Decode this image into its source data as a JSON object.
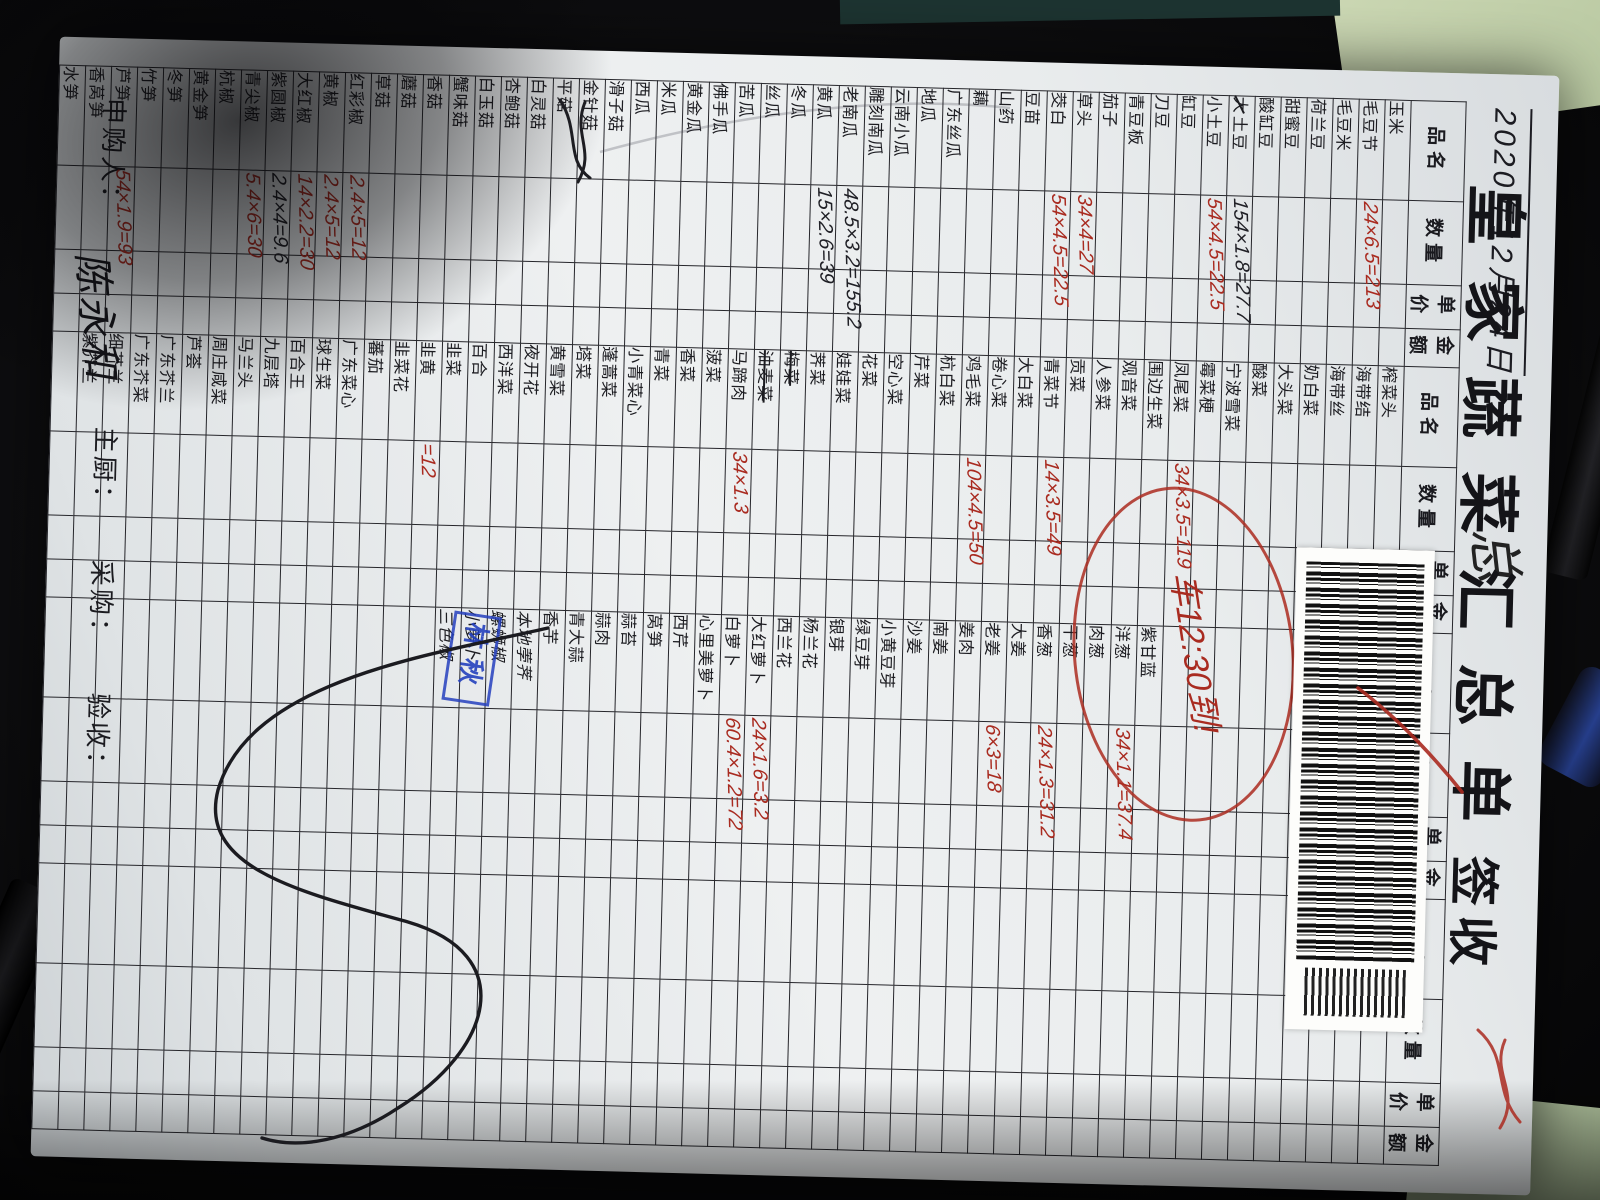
{
  "photo": {
    "background_color": "#0e0e10",
    "paper_color": "#e9eced",
    "grid_color": "#26262b",
    "red_ink": "#a92b20",
    "black_ink": "#202026",
    "stamp_blue": "#2440be",
    "mat_green": "#c2d0ab"
  },
  "header": {
    "date": "2020年12月24日",
    "date_note": "总",
    "title": "皇家蔬菜汇总单",
    "title_suffix": "签收"
  },
  "annotations": {
    "truck_note": "车12:30到!",
    "stamp_text": "林秋"
  },
  "footer": {
    "requester_label": "申购人：",
    "requester_signature": "陈永和",
    "chef_label": "主厨：",
    "purchaser_label": "采购：",
    "receiver_label": "验收："
  },
  "table": {
    "column_headers": [
      "品名",
      "数量",
      "单价",
      "金额"
    ],
    "row_count": 52,
    "groups": [
      {
        "start_row": 1,
        "items": [
          {
            "n": "玉米"
          },
          {
            "n": "毛豆节",
            "q": "24×6.5=213",
            "c": "red"
          },
          {
            "n": "毛豆米"
          },
          {
            "n": "荷兰豆"
          },
          {
            "n": "甜蜜豆"
          },
          {
            "n": "酸缸豆"
          },
          {
            "n": "土豆",
            "pre": "大",
            "q": "154×1.8=27.7",
            "c": "blk"
          },
          {
            "n": "小土豆",
            "q": "54×4.5=22.5",
            "c": "red"
          },
          {
            "n": "缸豆"
          },
          {
            "n": "刀豆"
          },
          {
            "n": "青豆板"
          },
          {
            "n": "茄子"
          },
          {
            "n": "草头",
            "q": "34×4=27",
            "c": "red"
          },
          {
            "n": "茭白",
            "q": "54×4.5=22.5",
            "c": "red"
          },
          {
            "n": "豆苗"
          },
          {
            "n": "山药"
          },
          {
            "n": "藕"
          },
          {
            "n": "广东丝瓜"
          },
          {
            "n": "地瓜"
          },
          {
            "n": "云南小瓜"
          },
          {
            "n": "雕刻南瓜"
          },
          {
            "n": "老南瓜",
            "q": "48.5×3.2=155.2",
            "c": "blk"
          },
          {
            "n": "黄瓜",
            "q": "15×2.6=39",
            "c": "blk"
          },
          {
            "n": "冬瓜"
          },
          {
            "n": "丝瓜"
          },
          {
            "n": "苦瓜"
          },
          {
            "n": "佛手瓜"
          },
          {
            "n": "黄金瓜"
          },
          {
            "n": "米瓜"
          },
          {
            "n": "西瓜"
          },
          {
            "n": "滑子菇"
          },
          {
            "n": "金针菇"
          },
          {
            "n": "平菇"
          },
          {
            "n": "白灵菇"
          },
          {
            "n": "杏鲍菇"
          },
          {
            "n": "白玉菇"
          },
          {
            "n": "蟹味菇"
          },
          {
            "n": "香菇"
          },
          {
            "n": "蘑菇"
          },
          {
            "n": "草菇"
          },
          {
            "n": "红彩椒",
            "q": "2.4×5=12",
            "c": "red"
          },
          {
            "n": "黄椒",
            "q": "2.4×5=12",
            "c": "red"
          },
          {
            "n": "大红椒",
            "q": "14×2.2=30",
            "c": "red"
          },
          {
            "n": "紫圆椒",
            "q": "2.4×4=9.6",
            "c": "blk"
          },
          {
            "n": "青尖椒",
            "q": "5.4×6=30",
            "c": "red"
          },
          {
            "n": "杭椒"
          },
          {
            "n": "黄金笋"
          },
          {
            "n": "冬笋"
          },
          {
            "n": "竹笋"
          },
          {
            "n": "芦笋",
            "q": "54×1.9=93",
            "c": "red"
          },
          {
            "n": "香莴笋"
          },
          {
            "n": "水笋"
          }
        ]
      },
      {
        "start_row": 1,
        "items": [
          {
            "n": "榨菜头"
          },
          {
            "n": "海带结"
          },
          {
            "n": "海带丝"
          },
          {
            "n": "奶白菜"
          },
          {
            "n": "大头菜"
          },
          {
            "n": "酸菜"
          },
          {
            "n": "宁波雪菜"
          },
          {
            "n": "霉菜梗"
          },
          {
            "n": "凤尾菜",
            "q": "34×3.5=119",
            "c": "red"
          },
          {
            "n": "围边生菜"
          },
          {
            "n": "观音菜"
          },
          {
            "n": "人参菜"
          },
          {
            "n": "贡菜"
          },
          {
            "n": "青菜节",
            "q": "14×3.5=49",
            "c": "red"
          },
          {
            "n": "大白菜"
          },
          {
            "n": "卷心菜"
          },
          {
            "n": "鸡毛菜",
            "q": "104×4.5=50",
            "c": "red"
          },
          {
            "n": "杭白菜"
          },
          {
            "n": "芹菜"
          },
          {
            "n": "空心菜"
          },
          {
            "n": "花菜"
          },
          {
            "n": "娃娃菜"
          },
          {
            "n": "荠菜"
          },
          {
            "n": "梅菜",
            "strike": true
          },
          {
            "n": "油麦菜",
            "strike": true
          },
          {
            "n": "马蹄肉",
            "q": "34×1.3",
            "c": "red"
          },
          {
            "n": "菠菜"
          },
          {
            "n": "香菜"
          },
          {
            "n": "青菜"
          },
          {
            "n": "小青菜心"
          },
          {
            "n": "蓬蒿菜"
          },
          {
            "n": "塔菜"
          },
          {
            "n": "黄雪菜"
          },
          {
            "n": "夜开花"
          },
          {
            "n": "西洋菜"
          },
          {
            "n": "百合"
          },
          {
            "n": "韭菜"
          },
          {
            "n": "韭黄",
            "q": "=12",
            "c": "red"
          },
          {
            "n": "韭菜花"
          },
          {
            "n": "蕃茄"
          },
          {
            "n": "广东菜心"
          },
          {
            "n": "球生菜"
          },
          {
            "n": "百合王"
          },
          {
            "n": "九层塔"
          },
          {
            "n": "马兰头"
          },
          {
            "n": "周庄咸菜"
          },
          {
            "n": "芦荟"
          },
          {
            "n": "广东芥兰"
          },
          {
            "n": "广东芥菜"
          },
          {
            "n": "细芥兰"
          },
          {
            "n": "紫芥兰"
          }
        ]
      },
      {
        "start_row": 10,
        "items": [
          {
            "n": "紫甘蓝"
          },
          {
            "n": "洋葱",
            "q": "34×1.1=37.4",
            "c": "red"
          },
          {
            "n": "肉葱"
          },
          {
            "n": "干葱"
          },
          {
            "n": "香葱",
            "q": "24×1.3=31.2",
            "c": "red"
          },
          {
            "n": "大姜"
          },
          {
            "n": "老姜",
            "q": "6×3=18",
            "c": "red"
          },
          {
            "n": "姜肉"
          },
          {
            "n": "南姜"
          },
          {
            "n": "沙姜"
          },
          {
            "n": "小黄豆芽"
          },
          {
            "n": "绿豆芽"
          },
          {
            "n": "银芽"
          },
          {
            "n": "杨兰花"
          },
          {
            "n": "西兰花"
          },
          {
            "n": "大红萝卜",
            "q": "24×1.6=3.2",
            "c": "red"
          },
          {
            "n": "白萝卜",
            "q": "60.4×1.2=72",
            "c": "red"
          },
          {
            "n": "心里美萝卜"
          },
          {
            "n": "西芹"
          },
          {
            "n": "莴笋"
          },
          {
            "n": "蒜苔"
          },
          {
            "n": "蒜肉"
          },
          {
            "n": "青大蒜"
          },
          {
            "n": "香芋"
          },
          {
            "n": "本地荸荠",
            "hw": true
          },
          {
            "n": "螺蛳椒",
            "hw": true
          },
          {
            "n": "小萝卜",
            "hw": true
          },
          {
            "n": "三色椒",
            "hw": true
          }
        ]
      },
      {
        "start_row": 1,
        "items": [
          {
            "n": "百果"
          },
          {
            "n": "红牛肝菌"
          },
          {
            "n": "榄干"
          },
          {
            "n": "紫橄榄"
          }
        ]
      }
    ]
  }
}
